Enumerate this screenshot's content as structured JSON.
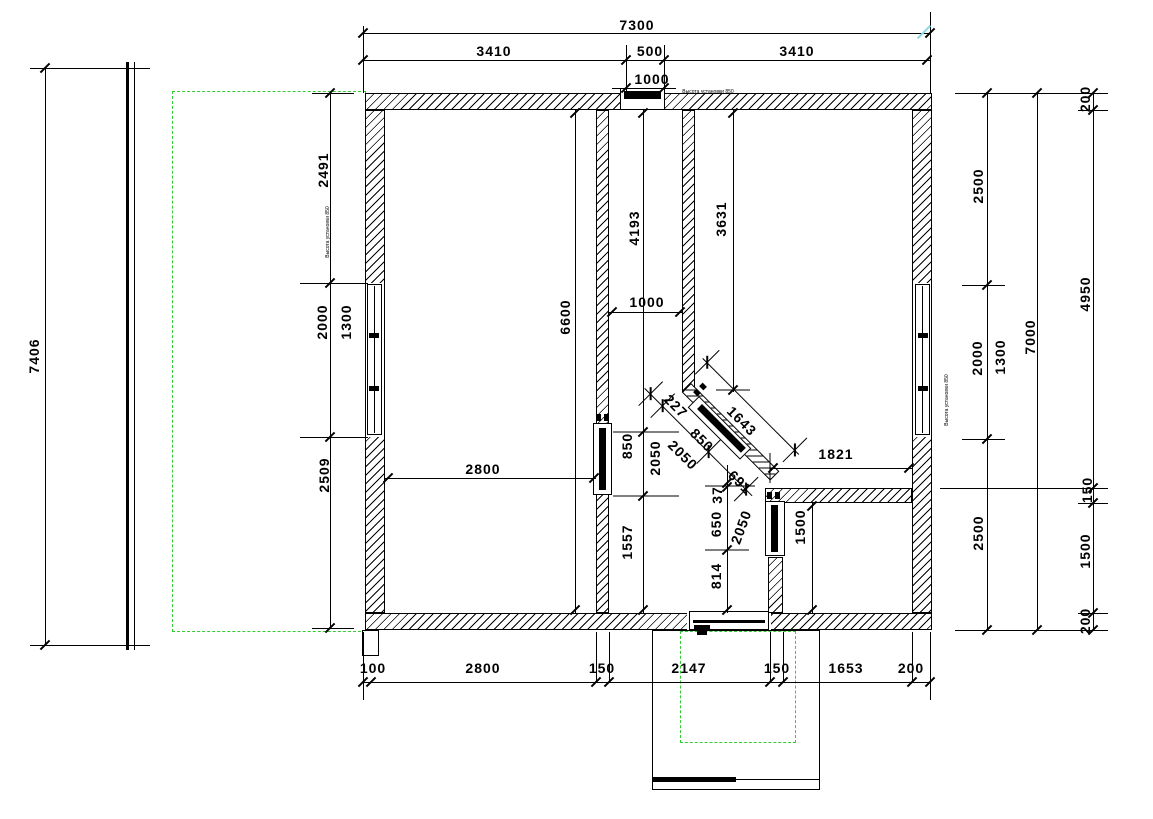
{
  "drawing": {
    "background": "#ffffff",
    "line_color": "#000000",
    "dashed_outline_color": "#33cc33",
    "highlight_tick_color": "#8fd8e8"
  },
  "dims": {
    "top_overall": "7300",
    "top_left": "3410",
    "top_center": "500",
    "top_right": "3410",
    "top_vent": "1000",
    "left_overall": "7406",
    "left_upper": "2491",
    "left_window_opening": "2000",
    "left_window": "1300",
    "left_lower": "2509",
    "right_upper": "2500",
    "right_window_opening": "2000",
    "right_window": "1300",
    "right_lower": "2500",
    "right_total": "7000",
    "right_wall_top": "200",
    "right_span_main": "4950",
    "right_wall_mid": "150",
    "right_lower_room": "1500",
    "right_wall_bottom": "200",
    "bottom_seg1": "100",
    "bottom_seg2": "2800",
    "bottom_seg3": "150",
    "bottom_seg4": "2147",
    "bottom_seg5": "150",
    "bottom_seg6": "1653",
    "bottom_seg7": "200",
    "left_room_height": "6600",
    "left_room_width": "2800",
    "corridor_upper": "4193",
    "corridor_width": "1000",
    "door_a_width": "850",
    "door_a_height": "2050",
    "corridor_lower": "1557",
    "right_room_height": "3631",
    "right_room_width": "1821",
    "diag_wall_length": "1643",
    "diag_seg1": "227",
    "diag_door_width": "850",
    "diag_door_height": "2050",
    "diag_seg2": "691",
    "gap_small": "37",
    "door_c_width": "650",
    "door_c_height": "2050",
    "bottom_passage": "814",
    "small_room_height": "1500"
  },
  "annotations": {
    "top_note": "Высота установки 850",
    "left_note": "Высота установки 850",
    "right_note": "Высота установки 850"
  }
}
